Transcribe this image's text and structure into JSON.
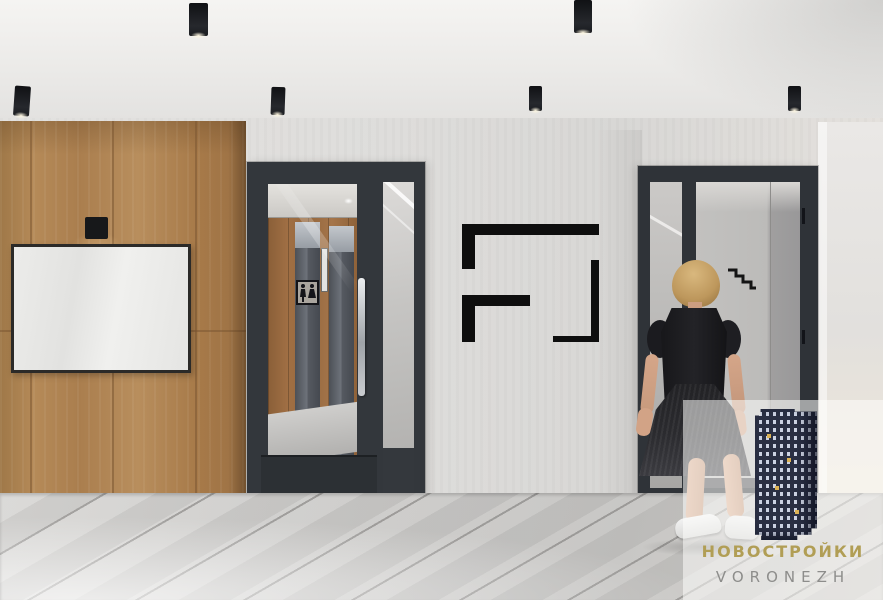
{
  "watermark": {
    "title": "НОВОСТРОЙКИ",
    "subtitle": "VORONEZH",
    "title_color": "#b19e55",
    "subtitle_color": "#8d8d8b",
    "panel_color": "rgba(253,253,252,0.55)"
  },
  "palette": {
    "ceiling": "#eeedeb",
    "wall": "#dfdedc",
    "wood": "#ac8152",
    "wood_seam": "#7c5733",
    "door_frame": "#33373c",
    "floor": "#c9c8c6",
    "logo_black": "#0e0e0e",
    "building_navy": "#2a2f43",
    "glow_warm": "#ffd9a0",
    "wm_gold": "#b19e55",
    "wm_gray": "#8d8d8b"
  },
  "icons": {
    "wall_logo": "frame-corners-logo",
    "stairs": "stairs-pictogram",
    "wc": "wc-sign",
    "building": "skyscraper-logo",
    "ceiling_lights": "cylinder-spotlight"
  }
}
